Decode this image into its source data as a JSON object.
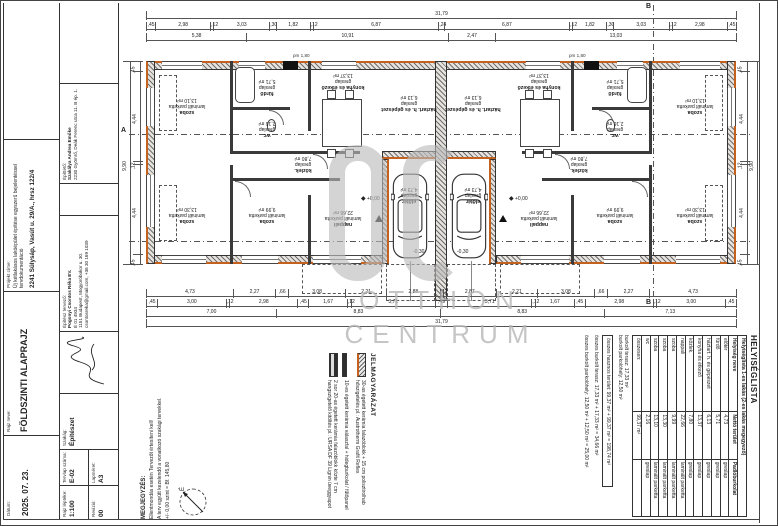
{
  "colors": {
    "accent_orange": "#c4611e",
    "watermark_gray": "#bababa",
    "line": "#333333"
  },
  "watermark": {
    "logo": "OC",
    "line1": "OTTHON",
    "line2": "CENTRUM"
  },
  "titleblock": {
    "date_label": "Dátum:",
    "date": "2025. 07. 23.",
    "name_label": "Rajz neve:",
    "name": "FÖLDSZINTI ALAPRAJZ",
    "project_label": "Projekt címe:",
    "project_desc": "Új kétlakásos lakóépület építése egyszerű bejelentéssel tervdokumentáció",
    "project_address": "2241 Sülysáp, Vasút u. 29/A., hrsz 122/4",
    "client_label": "Építtető:",
    "client_name": "Szakálya Andrea Emőke",
    "client_address": "2230 Gyömrő, Deák Ferenc utca 11. B ép. 1.",
    "architect_label": "Építész tervező:",
    "architect_name": "Pogonyi Csontos Réka EV.",
    "architect_reg": "É 01 4934",
    "architect_address": "1151 Budapest, Mogyoróbokor u. 30.",
    "architect_contact": "csontosreka@gmail.com, +36 30 169 1039",
    "discipline_label": "Szakág:",
    "discipline": "Építészet",
    "scale_label": "Rajz léptéke:",
    "scale": "1:100",
    "revision_label": "Revízió:",
    "revision": "00",
    "sheet_label": "Tervlap száma:",
    "sheet": "E-02",
    "size_label": "Lapméret:",
    "size": "A3"
  },
  "legend": {
    "title": "JELMAGYARÁZAT",
    "items": [
      {
        "symbol": "wall30",
        "text": "30-as égetett kerámia falazóblokk + 15 cm polisztirolhab hőszigetelés pl.: Austrotherm Grafit Reflex"
      },
      {
        "symbol": "wall10",
        "text": "10-es égetett kerámia válaszfal + hidegburkolat / fűtőpanel"
      },
      {
        "symbol": "wall2x20",
        "text": "2 sor 20-as égetett kerámia falazóblokk közte 7 cm hangszigetelő kitöltés pl.: URSA DF 39 Lignin üveggyapot"
      }
    ]
  },
  "notes": {
    "title": "MEGJEGYZÉS:",
    "lines": [
      "Ellentmondás esetén Tervezőt értesíteni kell!",
      "A terv együtt kezelendő a vonatkozó szakági tervekkel.",
      "+/- 0,00 szint = Bf. 145,80"
    ]
  },
  "north_label": "É",
  "room_table": {
    "title": "HELYISÉGLISTA",
    "subtitle": "Helyiséglista 1-es lakás (2-es lakás megegyező)",
    "headers": [
      "Helyiség neve",
      "Nettó terület",
      "Padlóburkolat"
    ],
    "rows": [
      [
        "előtér",
        "4,73",
        "greslap"
      ],
      [
        "fürdő",
        "5,71",
        "greslap"
      ],
      [
        "háztart. h. és gépészet",
        "6,13",
        "greslap"
      ],
      [
        "konyha és étkező",
        "13,37",
        "greslap"
      ],
      [
        "közlek.",
        "7,80",
        "greslap"
      ],
      [
        "nappali",
        "22,66",
        "laminált parketta"
      ],
      [
        "szoba",
        "9,99",
        "laminált parketta"
      ],
      [
        "szoba",
        "13,30",
        "laminált parketta"
      ],
      [
        "szoba",
        "13,10",
        "laminált parketta"
      ],
      [
        "wc",
        "2,16",
        "greslap"
      ]
    ],
    "total_label": "összesen:",
    "total": "99,37 m²",
    "extras": [
      "burkolt terasz: 17,33 m²",
      "burkolt parkolóhely: 12,50 m²"
    ],
    "summary": [
      "összes hasznos terület: 99,37 m² + 99,37 m² = 198,74 m²",
      "összes burkolt terasz: 17,33 m² + 17,33 m² = 34,66 m²",
      "összes burkolt parkolóhely: 12,50 m² + 12,50 m² = 25,00 m²"
    ]
  },
  "plan": {
    "levels": {
      "zero": "+0,00",
      "minus": "-0,30",
      "pm": "pm 1,80"
    },
    "markers": {
      "a": "A",
      "b": "B"
    },
    "rooms": [
      {
        "name": "szoba",
        "floor": "laminált parketta",
        "area": "13,10 m²",
        "x": 70,
        "y": 103
      },
      {
        "name": "szoba",
        "floor": "laminált parketta",
        "area": "13,30 m²",
        "x": 70,
        "y": 212
      },
      {
        "name": "szoba",
        "floor": "laminált parketta",
        "area": "9,99 m²",
        "x": 150,
        "y": 212
      },
      {
        "name": "fürdő",
        "floor": "greslap",
        "area": "5,71 m²",
        "x": 150,
        "y": 84
      },
      {
        "name": "wc",
        "floor": "greslap",
        "area": "2,16 m²",
        "x": 150,
        "y": 126
      },
      {
        "name": "konyha és étkező",
        "floor": "greslap",
        "area": "13,37 m²",
        "x": 226,
        "y": 78
      },
      {
        "name": "közlek.",
        "floor": "greslap",
        "area": "7,80 m²",
        "x": 186,
        "y": 161
      },
      {
        "name": "nappali",
        "floor": "laminált parketta",
        "area": "22,66 m²",
        "x": 226,
        "y": 215
      },
      {
        "name": "előtér",
        "floor": "greslap",
        "area": "4,73 m²",
        "x": 292,
        "y": 192
      },
      {
        "name": "háztart. h. és gépészet",
        "floor": "greslap",
        "area": "6,13 m²",
        "x": 292,
        "y": 100
      },
      {
        "name": "szoba",
        "floor": "laminált parketta",
        "area": "13,10 m²",
        "x": 578,
        "y": 103
      },
      {
        "name": "szoba",
        "floor": "laminált parketta",
        "area": "13,30 m²",
        "x": 578,
        "y": 212
      },
      {
        "name": "szoba",
        "floor": "laminált parketta",
        "area": "9,99 m²",
        "x": 498,
        "y": 212
      },
      {
        "name": "fürdő",
        "floor": "greslap",
        "area": "5,71 m²",
        "x": 498,
        "y": 84
      },
      {
        "name": "wc",
        "floor": "greslap",
        "area": "2,16 m²",
        "x": 498,
        "y": 126
      },
      {
        "name": "konyha és étkező",
        "floor": "greslap",
        "area": "13,37 m²",
        "x": 422,
        "y": 78
      },
      {
        "name": "közlek.",
        "floor": "greslap",
        "area": "7,80 m²",
        "x": 462,
        "y": 161
      },
      {
        "name": "nappali",
        "floor": "laminált parketta",
        "area": "22,66 m²",
        "x": 422,
        "y": 215
      },
      {
        "name": "előtér",
        "floor": "greslap",
        "area": "4,73 m²",
        "x": 356,
        "y": 192
      },
      {
        "name": "háztart. h. és gépészet",
        "floor": "greslap",
        "area": "6,13 m²",
        "x": 356,
        "y": 100
      }
    ],
    "dims": {
      "top_overall": [
        "31,79"
      ],
      "top_detail": [
        ",45",
        "2,98",
        ",12",
        "3,03",
        ",30",
        "1,82",
        ",12",
        "6,87",
        ",24",
        "6,87",
        ",12",
        "1,82",
        ",30",
        "3,03",
        ",12",
        "2,98",
        ",45"
      ],
      "top_mid": [
        "5,38",
        "10,91",
        "2,47",
        "13,03"
      ],
      "bottom_detail": [
        "4,73",
        "2,27",
        ",66",
        "3,08",
        "2,21",
        "2,88",
        ",12",
        "2,87",
        "2,21",
        "3,08",
        ",66",
        "2,27",
        "4,73"
      ],
      "bottom_mid": [
        ",45",
        "3,00",
        ",12",
        "2,98",
        ",45",
        "1,67",
        ",12",
        "3,71",
        ",49",
        "3,71",
        ",12",
        "1,67",
        ",45",
        "2,98",
        ",12",
        "3,00",
        ",45"
      ],
      "bottom_coarse": [
        "7,00",
        "8,83",
        "8,83",
        "7,13"
      ],
      "bottom_overall": [
        "31,79"
      ],
      "left_detail": [
        ",45",
        "4,44",
        ",12",
        "4,44",
        ",45"
      ],
      "left_overall": [
        "9,90"
      ],
      "right_detail": [
        ",45",
        "4,44",
        ",12",
        "4,44",
        ",45"
      ],
      "right_overall": [
        "9,90"
      ]
    }
  }
}
